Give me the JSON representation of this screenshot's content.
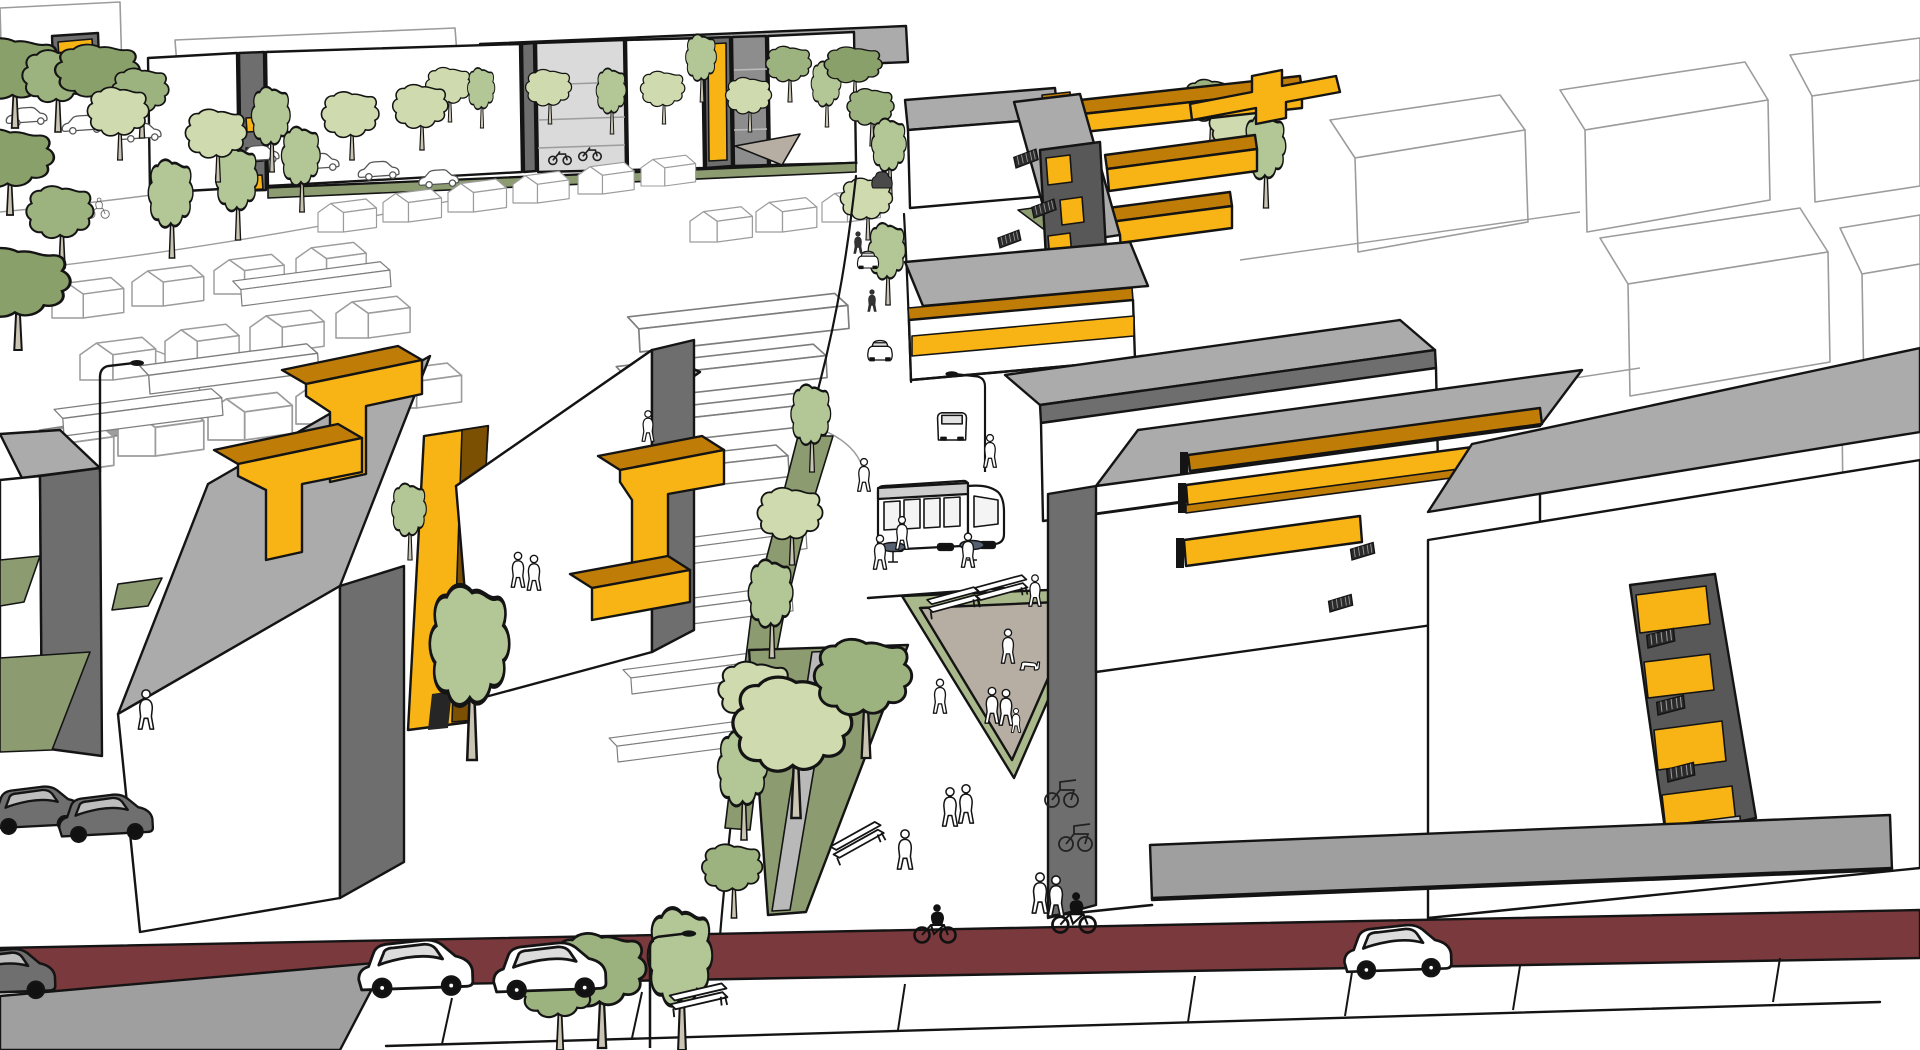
{
  "image_type": "architectural-3d-visualization",
  "colors": {
    "outline": "#141414",
    "ctx": "#9c9c9c",
    "white": "#ffffff",
    "roof": "#ababab",
    "roofLight": "#c6c6c6",
    "sideDark": "#6e6e6e",
    "dark": "#585858",
    "glass": "#dadada",
    "yellow": "#f8b414",
    "amber": "#bf7d08",
    "brown": "#7c5003",
    "olive": "#8d9c70",
    "oliveLight": "#aab98c",
    "pathGray": "#b9b9b9",
    "treeLight": "#cfdbae",
    "treeMid": "#b3c696",
    "treeDark": "#9db37f",
    "treeDarker": "#8aa06a",
    "trunk": "#c9c5b2",
    "maroon": "#7a393d",
    "plinth": "#9f9f9f",
    "taupe": "#b7aea3",
    "busGray": "#cdcdcd",
    "tableBlue": "#566071"
  },
  "scene": {
    "back_stamps": [
      [
        "h",
        318,
        232,
        0.75
      ],
      [
        "h",
        383,
        222,
        0.75
      ],
      [
        "h",
        448,
        212,
        0.75
      ],
      [
        "h",
        513,
        203,
        0.72
      ],
      [
        "h",
        578,
        194,
        0.72
      ],
      [
        "h",
        641,
        186,
        0.7
      ],
      [
        "h",
        296,
        282,
        0.9
      ],
      [
        "h",
        214,
        294,
        0.9
      ],
      [
        "h",
        132,
        306,
        0.92
      ],
      [
        "h",
        52,
        318,
        0.92
      ],
      [
        "h",
        336,
        338,
        0.95
      ],
      [
        "h",
        250,
        352,
        0.95
      ],
      [
        "h",
        165,
        366,
        0.95
      ],
      [
        "h",
        80,
        380,
        0.97
      ],
      [
        "h",
        28,
        472,
        1.1
      ],
      [
        "h",
        118,
        456,
        1.1
      ],
      [
        "h",
        208,
        440,
        1.08
      ],
      [
        "h",
        296,
        424,
        1.05
      ],
      [
        "h",
        382,
        408,
        1.02
      ],
      [
        "h",
        690,
        242,
        0.8
      ],
      [
        "h",
        756,
        232,
        0.78
      ],
      [
        "h",
        822,
        222,
        0.75
      ],
      [
        "g",
        640,
        352,
        1.05,
        -3
      ],
      [
        "g",
        628,
        400,
        1.0,
        -3
      ],
      [
        "g",
        614,
        448,
        0.98,
        -3
      ],
      [
        "g",
        600,
        498,
        0.95,
        -3
      ],
      [
        "g",
        658,
        568,
        0.75,
        -4
      ],
      [
        "g",
        646,
        630,
        0.74,
        -4
      ],
      [
        "g",
        632,
        694,
        0.73,
        -4
      ],
      [
        "g",
        618,
        762,
        0.72,
        -4
      ],
      [
        "g",
        150,
        394,
        0.85,
        -4
      ],
      [
        "g",
        64,
        436,
        0.8,
        -4
      ],
      [
        "g",
        242,
        306,
        0.75,
        -4
      ],
      [
        "cc",
        28,
        122,
        0.8,
        -4
      ],
      [
        "cc",
        84,
        130,
        0.8,
        -4
      ],
      [
        "cc",
        142,
        138,
        0.8,
        -4
      ],
      [
        "cc",
        260,
        160,
        0.8,
        -4
      ],
      [
        "cc",
        320,
        168,
        0.8,
        -4
      ],
      [
        "cc",
        380,
        176,
        0.8,
        -4
      ],
      [
        "cc",
        440,
        184,
        0.78,
        -4
      ],
      [
        "cyl",
        98,
        218,
        0.55
      ],
      [
        "bk",
        560,
        164,
        0.9
      ],
      [
        "bk",
        590,
        160,
        0.9
      ],
      [
        "t1",
        450,
        122,
        0.6
      ],
      [
        "t2",
        482,
        128,
        0.55
      ],
      [
        "t1",
        550,
        124,
        0.6
      ],
      [
        "t2",
        612,
        134,
        0.6
      ],
      [
        "t1",
        664,
        124,
        0.58
      ],
      [
        "t2",
        702,
        102,
        0.62
      ],
      [
        "t1",
        750,
        132,
        0.6
      ],
      [
        "t3",
        790,
        102,
        0.68
      ],
      [
        "t2",
        827,
        127,
        0.6
      ],
      [
        "t4",
        855,
        100,
        0.65
      ],
      [
        "t3",
        872,
        146,
        0.7
      ],
      [
        "t2",
        890,
        195,
        0.7
      ],
      [
        "t1",
        868,
        240,
        0.68
      ],
      [
        "t2",
        888,
        305,
        0.75
      ],
      [
        "t4",
        15,
        128,
        1.1
      ],
      [
        "t3",
        58,
        132,
        1.0
      ],
      [
        "t4",
        100,
        122,
        0.95
      ],
      [
        "t3",
        142,
        138,
        0.85
      ],
      [
        "t4",
        10,
        215,
        1.05
      ],
      [
        "t3",
        62,
        268,
        1.0
      ],
      [
        "t4",
        18,
        350,
        1.25
      ],
      [
        "t2",
        172,
        258,
        0.9
      ],
      [
        "t2",
        238,
        240,
        0.85
      ],
      [
        "t1",
        218,
        182,
        0.8
      ],
      [
        "t2",
        272,
        172,
        0.78
      ],
      [
        "t1",
        352,
        160,
        0.75
      ],
      [
        "t2",
        302,
        212,
        0.78
      ],
      [
        "t1",
        422,
        150,
        0.72
      ],
      [
        "t1",
        120,
        160,
        0.8
      ],
      [
        "t3",
        1212,
        145,
        0.8
      ],
      [
        "t1",
        1242,
        172,
        0.8
      ],
      [
        "t2",
        1266,
        208,
        0.85
      ]
    ],
    "front_stamps": [
      [
        "t2",
        812,
        472,
        0.8
      ],
      [
        "t1",
        792,
        565,
        0.85
      ],
      [
        "t2",
        772,
        658,
        0.9
      ],
      [
        "t1",
        757,
        748,
        0.95
      ],
      [
        "t2",
        744,
        840,
        1.0
      ],
      [
        "t3",
        734,
        918,
        0.9
      ],
      [
        "t1",
        796,
        818,
        1.55
      ],
      [
        "t3",
        866,
        758,
        1.45
      ],
      [
        "t2",
        410,
        560,
        0.7
      ],
      [
        "t2",
        472,
        760,
        1.6
      ],
      [
        "t3",
        602,
        1048,
        1.4
      ],
      [
        "t2",
        682,
        1050,
        1.3
      ],
      [
        "t3",
        560,
        1050,
        1.1
      ],
      [
        "cs",
        868,
        268,
        0.62
      ],
      [
        "cs",
        880,
        360,
        0.72
      ],
      [
        "csd",
        882,
        188,
        0.6
      ],
      [
        "cv",
        952,
        440,
        0.85
      ],
      [
        "lm",
        100,
        472,
        1.0
      ],
      [
        "lmf",
        985,
        472,
        0.9
      ],
      [
        "lm",
        650,
        1048,
        1.05
      ],
      [
        "tb",
        893,
        562,
        1.0
      ],
      [
        "tb",
        972,
        560,
        1.0
      ],
      [
        "b",
        955,
        612,
        1.0,
        -8
      ],
      [
        "b",
        1003,
        600,
        1.0,
        -8
      ],
      [
        "b",
        862,
        852,
        1.05,
        -22
      ],
      [
        "b",
        700,
        1010,
        1.1,
        -6
      ],
      [
        "rk",
        1062,
        806,
        1.0
      ],
      [
        "rk",
        1076,
        850,
        1.0
      ],
      [
        "st",
        1016,
        168,
        0.9,
        -12
      ],
      [
        "st",
        1034,
        218,
        0.9,
        -12
      ],
      [
        "st",
        1000,
        248,
        0.85,
        -12
      ],
      [
        "st",
        1330,
        612,
        0.9,
        -8
      ],
      [
        "st",
        1352,
        560,
        0.9,
        -8
      ],
      [
        "st",
        1648,
        648,
        1.05,
        -6
      ],
      [
        "st",
        1658,
        715,
        1.05,
        -6
      ],
      [
        "st",
        1668,
        782,
        1.05,
        -6
      ],
      [
        "p",
        864,
        492,
        0.75
      ],
      [
        "p",
        990,
        468,
        0.75
      ],
      [
        "p",
        902,
        550,
        0.75
      ],
      [
        "p",
        880,
        570,
        0.78
      ],
      [
        "p",
        968,
        568,
        0.78
      ],
      [
        "p",
        146,
        730,
        0.9
      ],
      [
        "p",
        518,
        588,
        0.8
      ],
      [
        "p",
        534,
        591,
        0.8
      ],
      [
        "p",
        1008,
        664,
        0.78
      ],
      [
        "p",
        1035,
        607,
        0.72
      ],
      [
        "p",
        992,
        724,
        0.82
      ],
      [
        "p",
        1006,
        726,
        0.82
      ],
      [
        "p",
        1016,
        733,
        0.55
      ],
      [
        "p",
        940,
        714,
        0.78
      ],
      [
        "p",
        950,
        827,
        0.88
      ],
      [
        "p",
        966,
        824,
        0.88
      ],
      [
        "p",
        905,
        870,
        0.9
      ],
      [
        "p",
        1040,
        914,
        0.92
      ],
      [
        "p",
        1056,
        917,
        0.92
      ],
      [
        "p",
        648,
        442,
        0.7
      ],
      [
        "pd",
        858,
        254,
        0.5
      ],
      [
        "pd",
        872,
        312,
        0.5
      ],
      [
        "dg",
        1028,
        670,
        0.8
      ],
      [
        "cy",
        935,
        942,
        1.0
      ],
      [
        "cy",
        1074,
        932,
        1.05
      ],
      [
        "cw",
        418,
        988,
        1.28,
        -2
      ],
      [
        "cw",
        552,
        990,
        1.26,
        -2
      ],
      [
        "cw",
        1400,
        970,
        1.2,
        -2
      ],
      [
        "cd",
        38,
        826,
        1.05,
        -3
      ],
      [
        "cd",
        108,
        834,
        1.05,
        -3
      ],
      [
        "cd",
        6,
        992,
        1.15,
        -2
      ]
    ]
  }
}
